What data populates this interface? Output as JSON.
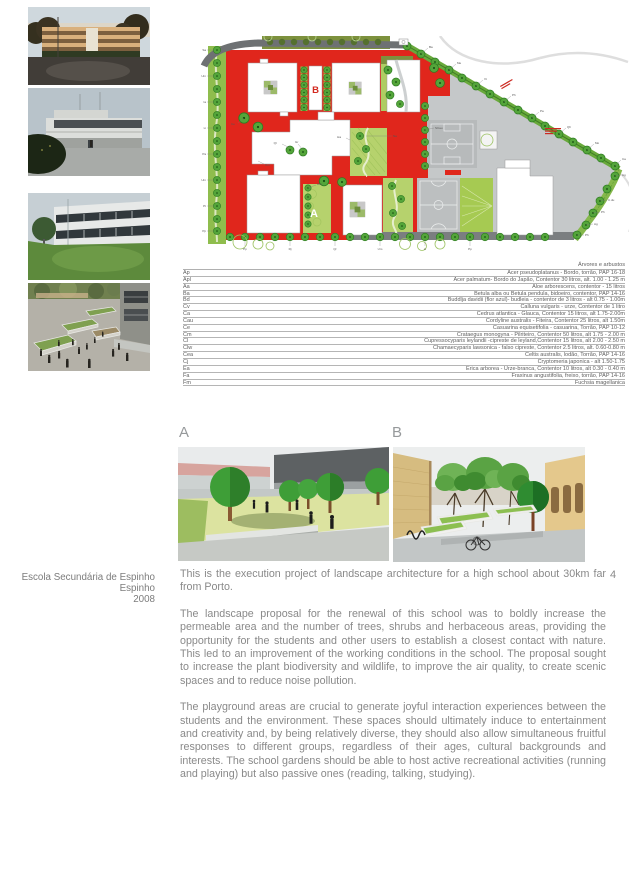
{
  "page": {
    "number": "4"
  },
  "project": {
    "title": "Escola Secundária de Espinho",
    "location": "Espinho",
    "year": "2008"
  },
  "plan": {
    "label_a": "A",
    "label_b": "B",
    "edge_left": [
      "Sa",
      "Um",
      "Ia",
      "Li",
      "Pa",
      "Um",
      "Pt",
      "Pp"
    ],
    "edge_diag": [
      "Ba",
      "Me",
      "Vt",
      "Ph",
      "Pa",
      "Qh",
      "Mo",
      "Ca"
    ],
    "edge_right": [
      "Ag",
      "C.du",
      "Ph",
      "Ag",
      "Ph"
    ],
    "edge_bottom": [
      "Pp",
      "Rj",
      "Qr",
      "Um",
      "Li",
      "Pp"
    ],
    "inner": [
      "ALu",
      "Qr",
      "Gr",
      "Um",
      "Ce",
      "Na",
      "SCau",
      "Ha"
    ]
  },
  "legend": {
    "header": "Árvores e arbustos",
    "rows": [
      {
        "code": "Ap",
        "desc": "Acer pseudoplatanus - Bordo, torrão, PAP 16-18"
      },
      {
        "code": "Apl",
        "desc": "Acer palmatum- Bordo do Japão, Contentor 30 litros, alt. 1.00 - 1.25 m"
      },
      {
        "code": "Aa",
        "desc": "Aloe arborescens, contentor - 15 litros"
      },
      {
        "code": "Ba",
        "desc": "Betula alba ou Betula pendula, bidoeiro, contentor, PAP 14-16"
      },
      {
        "code": "Bd",
        "desc": "Buddlja davidii (flor azul)- budleia - contentor de 3 litros - alt 0.75 - 1.00m"
      },
      {
        "code": "Cv",
        "desc": "Calluna vulgaris - urze, Contentor de 1 litro"
      },
      {
        "code": "Ca",
        "desc": "Cedrus atlantica - Glauca, Contentor 15 litros, alt 1.75-2.00m"
      },
      {
        "code": "Cau",
        "desc": "Cordyline australis - Fiteira, Contentor 25 litros, alt 1.50m"
      },
      {
        "code": "Ce",
        "desc": "Casuarina equisetifolia - casuarina, Torrão, PAP 10-12"
      },
      {
        "code": "Cm",
        "desc": "Crataegus monogyna - Pilriteiro, Contentor 50 litros, alt 1.75 - 2.00 m"
      },
      {
        "code": "Cl",
        "desc": "Cupressocyparis leylandii -cipreste de leyland,Contentor 15 litros, alt 2.00 - 2.50 m"
      },
      {
        "code": "Clw",
        "desc": "Chamaecyparis lawsonica - falso cipreste, Contentor 2.5 litros, alt. 0.60-0.80 m"
      },
      {
        "code": "Cea",
        "desc": "Celtis australis, lodão, Torrão, PAP 14-16"
      },
      {
        "code": "Cj",
        "desc": "Cryptomeria japonica - alt 1.50-1.75"
      },
      {
        "code": "Ea",
        "desc": "Erica arborea - Urze-branca, Contentor 10 litros, alt 0.30 - 0.40 m"
      },
      {
        "code": "Fa",
        "desc": "Fraxinus angustifolia, freixo, torrão, PAP 14-16"
      },
      {
        "code": "Fm",
        "desc": "Fuchsia magellanica"
      }
    ]
  },
  "renders": {
    "label_a": "A",
    "label_b": "B"
  },
  "body": {
    "paragraphs": [
      "This is the execution project of landscape architecture for a high school about 30km far from Porto.",
      "The landscape proposal for the renewal of this school was to boldly increase the permeable area and the number of trees, shrubs and herbaceous areas, providing the opportunity for the students and other users to establish a closest contact with nature. This led to an improvement of the working conditions in the school. The proposal sought to increase the plant biodiversity and wildlife, to improve the air quality, to create scenic spaces and to reduce noise pollution.",
      "The playground areas are crucial to generate joyful interaction experiences between the students and the environment. These spaces should ultimately induce to entertainment and creativity and, by being relatively diverse, they should also allow simultaneous fruitful responses to different groups, regardless of their ages, cultural backgrounds and interests. The school gardens should be able to host active recreational activities (running and playing) but also passive ones (reading, talking, studying)."
    ]
  },
  "colors": {
    "plaza_red": "#e0261c",
    "tree_green": "#54a53a",
    "lawn_green": "#b6d26d",
    "court_gray": "#c5c8c9",
    "text_gray": "#898989"
  }
}
